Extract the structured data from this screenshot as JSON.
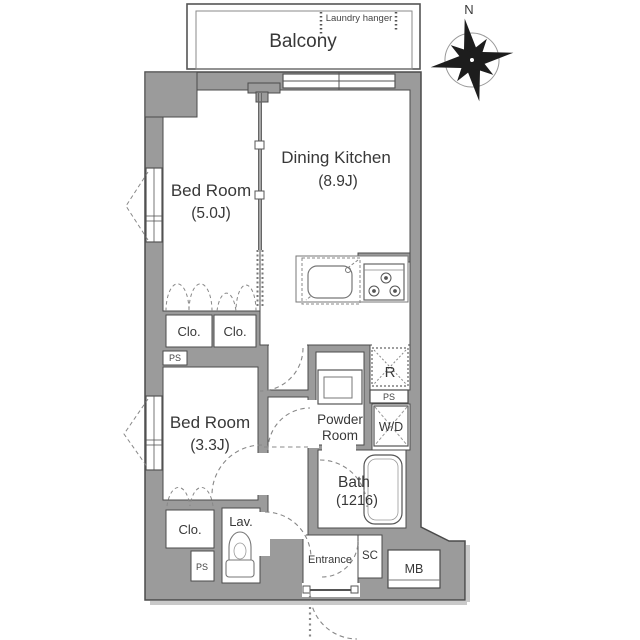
{
  "colors": {
    "wall": "#9b9b9b",
    "outline": "#4b4b4b",
    "text": "#3a3a3a",
    "background": "#ffffff",
    "shadow": "#c9c9c9"
  },
  "compass": {
    "north": "N"
  },
  "balcony": {
    "label": "Balcony",
    "laundry": "Laundry hanger"
  },
  "rooms": {
    "dining_kitchen": {
      "name": "Dining Kitchen",
      "size": "(8.9J)"
    },
    "bedroom1": {
      "name": "Bed Room",
      "size": "(5.0J)"
    },
    "bedroom2": {
      "name": "Bed Room",
      "size": "(3.3J)"
    },
    "powder": {
      "line1": "Powder",
      "line2": "Room"
    },
    "bath": {
      "name": "Bath",
      "size": "(1216)"
    },
    "lav": {
      "name": "Lav."
    },
    "entrance": {
      "name": "Entrance"
    }
  },
  "fixtures": {
    "closet": "Clo.",
    "pipe_shaft": "PS",
    "fridge": "R",
    "washer_dryer": "W/D",
    "shoe_closet": "SC",
    "meter_box": "MB"
  }
}
